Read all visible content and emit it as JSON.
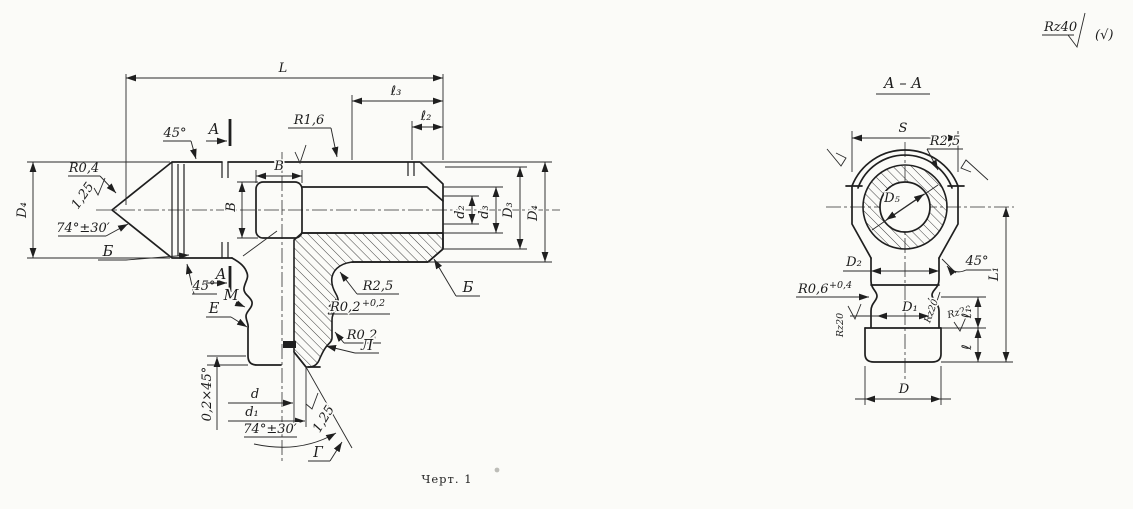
{
  "general": {
    "corner_finish": "Rz40",
    "corner_rest_mark": "(√)",
    "caption": "Черт. 1"
  },
  "left_view": {
    "dims": {
      "overall_length": "L",
      "l3": "ℓ₃",
      "l2": "ℓ₂",
      "width_h": "В",
      "width_v": "В",
      "D4_left": "D₄",
      "d2": "d₂",
      "d3": "d₃",
      "D3": "D₃",
      "D4_right": "D₄",
      "bore": "d",
      "cone_mouth": "d₁",
      "chamfer": "0,2×45°",
      "cone_angle_top": "74°±30′",
      "cone_angle_bottom": "74°±30′",
      "chamfer45_top": "45°",
      "chamfer45_mid": "45°"
    },
    "radii": {
      "r04": "R0,4",
      "r16": "R1,6",
      "r25": "R2,5",
      "r02a": "R0,2",
      "r02a_tol": "+0,2",
      "r02b": "R0,2"
    },
    "roughness": {
      "ra125_left": "1,25",
      "ra125_bottom": "1,25"
    },
    "letters": {
      "section_a_top": "A",
      "section_a_mid": "A",
      "b_left": "Б",
      "b_right": "Б",
      "m": "М",
      "e": "Е",
      "l": "Л",
      "g": "Г"
    }
  },
  "section_view": {
    "title": "А – А",
    "dims": {
      "across_flats": "S",
      "d5": "D₅",
      "d2": "D₂",
      "d1": "D₁",
      "d": "D",
      "l1_overall": "L₁",
      "l1": "ℓ₁",
      "l": "ℓ",
      "chamfer45": "45°"
    },
    "radii": {
      "r25": "R2,5",
      "r06": "R0,6",
      "r06_tol": "+0,4"
    },
    "roughness": {
      "rz20_left": "Rz20",
      "rz20_inner": "Rz20",
      "rz20_outer": "Rz20"
    }
  }
}
